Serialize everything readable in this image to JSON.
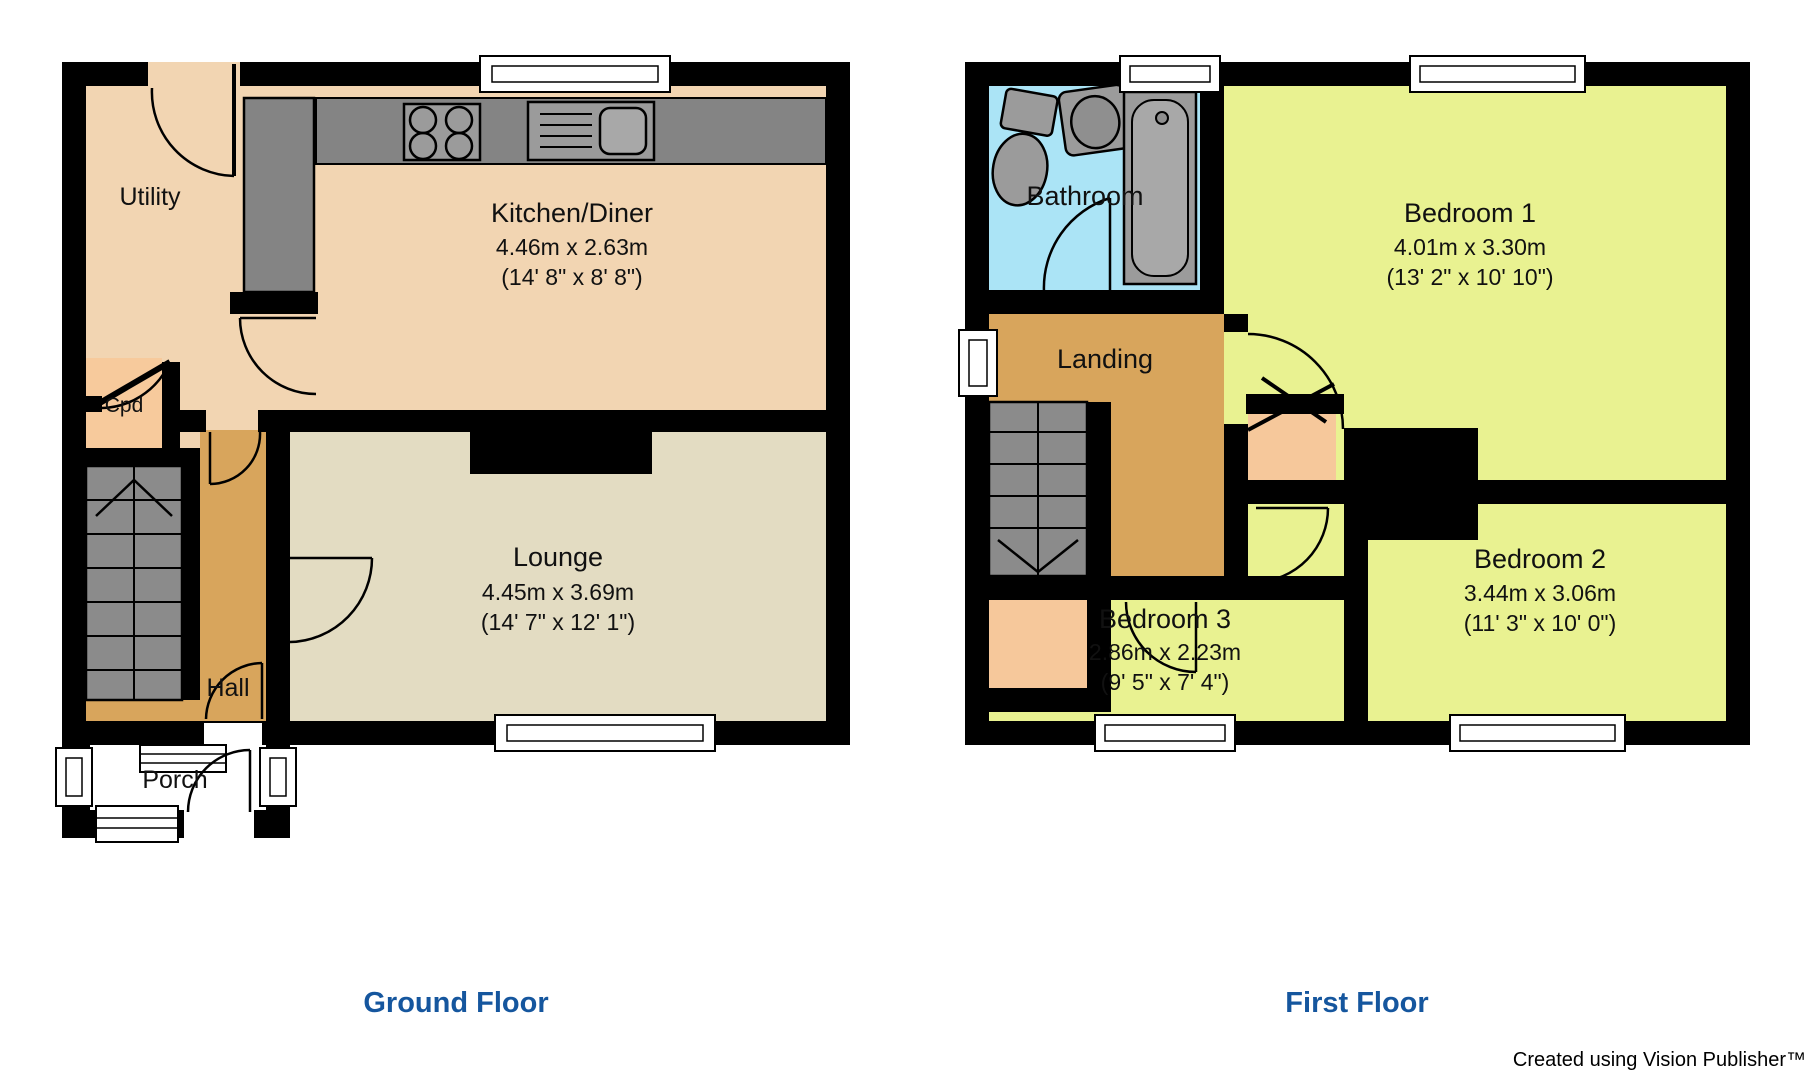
{
  "watermark": "Created using Vision Publisher™",
  "colors": {
    "wall": "#000000",
    "kitchen_utility_floor": "#F2D5B2",
    "cupboard_floor": "#F6C89B",
    "hall_landing_floor": "#D8A55C",
    "lounge_floor": "#E3DCC2",
    "bedroom_floor": "#E9F291",
    "bathroom_floor": "#ABE4F6",
    "stairs_gray": "#8B8B8B",
    "counter_gray": "#848484",
    "fixture_gray": "#9B9B9B",
    "floor_label_blue": "#15569E"
  },
  "icons": [
    "hob-icon",
    "sink-icon",
    "bath-icon",
    "toilet-icon",
    "basin-icon",
    "stairs-icon",
    "window-icon",
    "door-arc-icon"
  ],
  "floors": [
    {
      "label": "Ground Floor",
      "rooms": [
        {
          "name": "Utility"
        },
        {
          "name": "Kitchen/Diner",
          "metric": "4.46m x 2.63m",
          "imperial": "(14' 8\" x 8' 8\")"
        },
        {
          "name": "Cpd"
        },
        {
          "name": "Hall"
        },
        {
          "name": "Lounge",
          "metric": "4.45m x 3.69m",
          "imperial": "(14' 7\" x 12' 1\")"
        },
        {
          "name": "Porch"
        }
      ]
    },
    {
      "label": "First Floor",
      "rooms": [
        {
          "name": "Bathroom"
        },
        {
          "name": "Landing"
        },
        {
          "name": "Bedroom 1",
          "metric": "4.01m x 3.30m",
          "imperial": "(13' 2\" x 10' 10\")"
        },
        {
          "name": "Bedroom 2",
          "metric": "3.44m x 3.06m",
          "imperial": "(11' 3\" x 10' 0\")"
        },
        {
          "name": "Bedroom 3",
          "metric": "2.86m x 2.23m",
          "imperial": "(9' 5\" x 7' 4\")"
        }
      ]
    }
  ]
}
